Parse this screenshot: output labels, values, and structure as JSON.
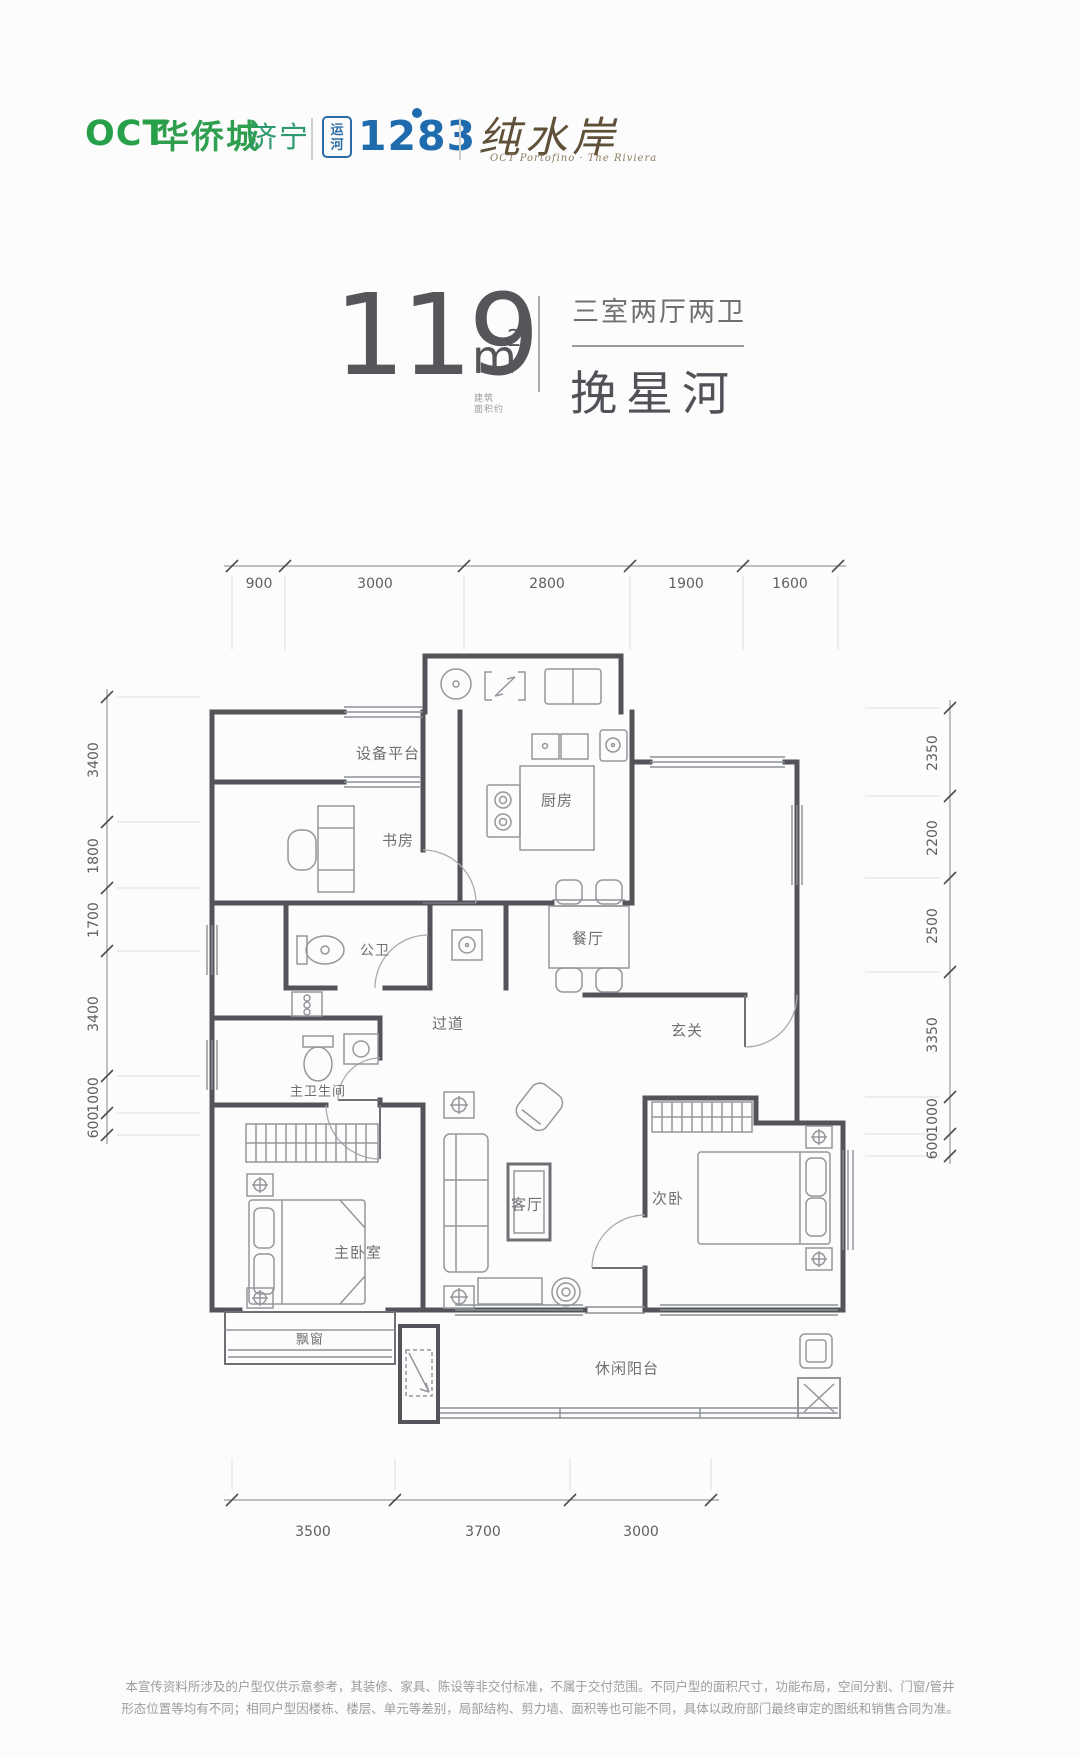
{
  "header": {
    "oct": "OCT",
    "brand": "华侨城",
    "city": "济宁",
    "canal_name_line1": "运",
    "canal_name_line2": "河",
    "canal_number": "1283",
    "estate_name": "纯水岸",
    "estate_subtitle": "OCT Portofino · The Riviera"
  },
  "title": {
    "area": "119",
    "unit": "m",
    "unit_sup": "2",
    "area_note_line1": "建筑",
    "area_note_line2": "面积约",
    "layout": "三室两厅两卫",
    "plan_name": "挽星河"
  },
  "floorplan": {
    "room_labels": [
      {
        "t": "设备平台",
        "x": 388,
        "y": 753
      },
      {
        "t": "书房",
        "x": 398,
        "y": 840
      },
      {
        "t": "厨房",
        "x": 557,
        "y": 800
      },
      {
        "t": "餐厅",
        "x": 588,
        "y": 938
      },
      {
        "t": "公卫",
        "x": 375,
        "y": 950,
        "s": 14
      },
      {
        "t": "过道",
        "x": 448,
        "y": 1023
      },
      {
        "t": "玄关",
        "x": 687,
        "y": 1030
      },
      {
        "t": "主卫生间",
        "x": 318,
        "y": 1090,
        "s": 13
      },
      {
        "t": "客厅",
        "x": 527,
        "y": 1204
      },
      {
        "t": "次卧",
        "x": 668,
        "y": 1198
      },
      {
        "t": "主卧室",
        "x": 358,
        "y": 1252
      },
      {
        "t": "飘窗",
        "x": 310,
        "y": 1338,
        "s": 13
      },
      {
        "t": "休闲阳台",
        "x": 627,
        "y": 1368
      }
    ],
    "dim_labels": [
      {
        "t": "900",
        "x": 259,
        "y": 584
      },
      {
        "t": "3000",
        "x": 375,
        "y": 584
      },
      {
        "t": "2800",
        "x": 547,
        "y": 584
      },
      {
        "t": "1900",
        "x": 686,
        "y": 584
      },
      {
        "t": "1600",
        "x": 790,
        "y": 584
      },
      {
        "t": "3500",
        "x": 313,
        "y": 1532
      },
      {
        "t": "3700",
        "x": 483,
        "y": 1532
      },
      {
        "t": "3000",
        "x": 641,
        "y": 1532
      },
      {
        "t": "3400",
        "x": 94,
        "y": 760,
        "v": true
      },
      {
        "t": "1800",
        "x": 94,
        "y": 856,
        "v": true
      },
      {
        "t": "1700",
        "x": 94,
        "y": 920,
        "v": true
      },
      {
        "t": "3400",
        "x": 94,
        "y": 1014,
        "v": true
      },
      {
        "t": "1000",
        "x": 94,
        "y": 1095,
        "v": true
      },
      {
        "t": "600",
        "x": 94,
        "y": 1125,
        "v": true
      },
      {
        "t": "2350",
        "x": 933,
        "y": 753,
        "v": true
      },
      {
        "t": "2200",
        "x": 933,
        "y": 838,
        "v": true
      },
      {
        "t": "2500",
        "x": 933,
        "y": 926,
        "v": true
      },
      {
        "t": "3350",
        "x": 933,
        "y": 1035,
        "v": true
      },
      {
        "t": "1000",
        "x": 933,
        "y": 1116,
        "v": true
      },
      {
        "t": "600",
        "x": 933,
        "y": 1146,
        "v": true
      }
    ]
  },
  "footer": {
    "line1": "本宣传资料所涉及的户型仅供示意参考，其装修、家具、陈设等非交付标准，不属于交付范围。不同户型的面积尺寸，功能布局，空间分割、门窗/管井",
    "line2": "形态位置等均有不同；相同户型因楼栋、楼层、单元等差别，局部结构、剪力墙、面积等也可能不同，具体以政府部门最终审定的图纸和销售合同为准。"
  }
}
